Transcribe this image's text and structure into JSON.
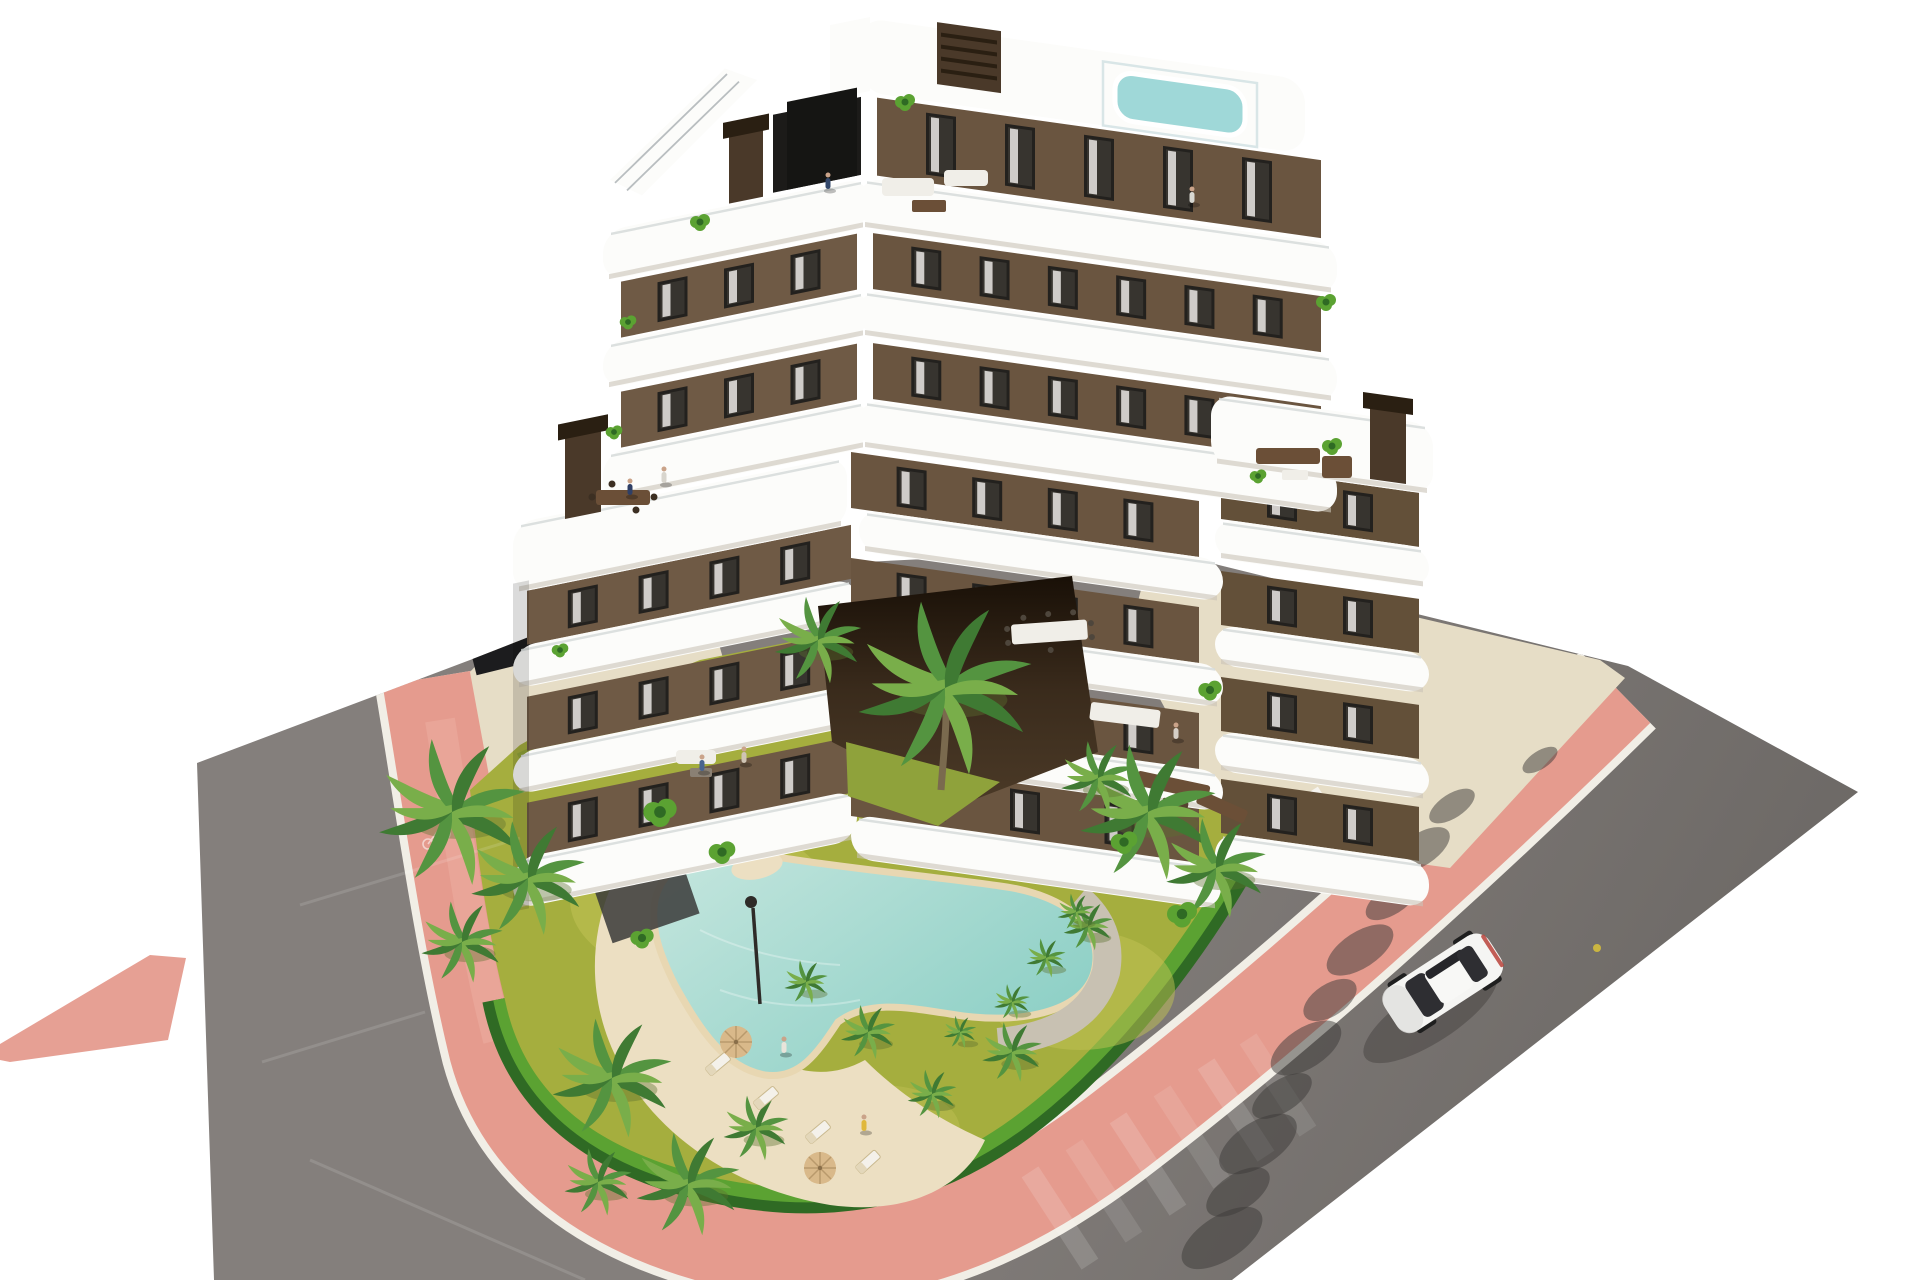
{
  "scene": {
    "kind": "aerial-architectural-render-of-apartment-building-with-pool-garden-and-road",
    "background": "white"
  },
  "palette": {
    "bg": "#ffffff",
    "road1": "#847f7c",
    "road2": "#6d6966",
    "pink": "#e59b8e",
    "pinkLight": "#eeb0a2",
    "curb": "#f1eee6",
    "beige": "#e6ddc6",
    "beigeTerr": "#dcd1ba",
    "grass": "#a5ae3e",
    "grassLight": "#c1c254",
    "grassDark": "#7e9a36",
    "hedgeDark": "#2f6a24",
    "hedgeLight": "#5ba232",
    "palmDark": "#3f7a33",
    "palmMid": "#549440",
    "palmLight": "#79ae4a",
    "trunk": "#7a6a4e",
    "sand": "#ecdfc2",
    "coping": "#e8d7b2",
    "water": "#8ccfc5",
    "waterLight": "#c5e6de",
    "gravel": "#c8c1b2",
    "slab": "#fcfcfa",
    "slabShadow": "#c9c3b8",
    "wallL": "#6f5a45",
    "wallC": "#6a5540",
    "wallR": "#635039",
    "winFrame": "#23211e",
    "winGlass": "#37342f",
    "curtain": "#eae8e4",
    "dark": "#1c1b19",
    "chimney": "#4a3929",
    "chimneyCap": "#2a1f12",
    "rail": "#d6dbd9",
    "furniture": "#6b4f37",
    "furnWhite": "#f0eee8",
    "carWhite": "#f5f5f3",
    "carGlass": "#2e2e32",
    "shadow": "#45423f",
    "blotch": "#3c3a38",
    "courtA": "#3a2b1c",
    "courtB": "#191007",
    "towel": "#e0b83c",
    "poolRoof": "#9fd8d8",
    "yellow": "#d9c23a"
  },
  "building": {
    "window": {
      "w": 30,
      "inset": 8
    },
    "left": {
      "walls": [
        {
          "x": -244,
          "y": 232,
          "w": 236,
          "h": 56,
          "n": 3
        },
        {
          "x": -244,
          "y": 342,
          "w": 236,
          "h": 56,
          "n": 3
        },
        {
          "x": -338,
          "y": 522,
          "w": 324,
          "h": 54,
          "n": 4
        },
        {
          "x": -338,
          "y": 628,
          "w": 324,
          "h": 54,
          "n": 4
        },
        {
          "x": -338,
          "y": 734,
          "w": 324,
          "h": 56,
          "n": 4
        }
      ],
      "slabs": [
        {
          "x": -262,
          "y": 178,
          "w": 266,
          "h": 50
        },
        {
          "x": -262,
          "y": 290,
          "w": 266,
          "h": 46
        },
        {
          "x": -262,
          "y": 400,
          "w": 266,
          "h": 48
        },
        {
          "x": -352,
          "y": 452,
          "w": 334,
          "h": 70
        },
        {
          "x": -352,
          "y": 576,
          "w": 344,
          "h": 42
        },
        {
          "x": -352,
          "y": 682,
          "w": 344,
          "h": 42
        },
        {
          "x": -352,
          "y": 788,
          "w": 344,
          "h": 50
        }
      ]
    },
    "right": {
      "walls": [
        {
          "x": 12,
          "y": 96,
          "w": 444,
          "h": 78,
          "n": 5
        },
        {
          "x": 8,
          "y": 232,
          "w": 448,
          "h": 56,
          "n": 6
        },
        {
          "x": 8,
          "y": 342,
          "w": 448,
          "h": 56,
          "n": 6
        },
        {
          "x": -14,
          "y": 454,
          "w": 348,
          "h": 56,
          "n": 4
        },
        {
          "x": -14,
          "y": 560,
          "w": 348,
          "h": 56,
          "n": 4
        },
        {
          "x": -14,
          "y": 666,
          "w": 348,
          "h": 56,
          "n": 4
        },
        {
          "x": -14,
          "y": 760,
          "w": 348,
          "h": 58,
          "n": 3
        },
        {
          "x": 356,
          "y": 415,
          "w": 198,
          "h": 54,
          "n": 2
        },
        {
          "x": 356,
          "y": 521,
          "w": 198,
          "h": 54,
          "n": 2
        },
        {
          "x": 356,
          "y": 627,
          "w": 198,
          "h": 54,
          "n": 2
        },
        {
          "x": 356,
          "y": 729,
          "w": 198,
          "h": 54,
          "n": 2
        }
      ],
      "slabs": [
        {
          "x": -6,
          "y": 178,
          "w": 478,
          "h": 50
        },
        {
          "x": -6,
          "y": 290,
          "w": 478,
          "h": 46
        },
        {
          "x": -6,
          "y": 400,
          "w": 478,
          "h": 48
        },
        {
          "x": 346,
          "y": 345,
          "w": 222,
          "h": 70
        },
        {
          "x": -6,
          "y": 510,
          "w": 364,
          "h": 42
        },
        {
          "x": -6,
          "y": 616,
          "w": 364,
          "h": 42
        },
        {
          "x": -6,
          "y": 722,
          "w": 364,
          "h": 40
        },
        {
          "x": 350,
          "y": 469,
          "w": 214,
          "h": 40
        },
        {
          "x": 350,
          "y": 575,
          "w": 214,
          "h": 40
        },
        {
          "x": 350,
          "y": 681,
          "w": 214,
          "h": 40
        },
        {
          "x": 350,
          "y": 783,
          "w": 214,
          "h": 46
        },
        {
          "x": -14,
          "y": 816,
          "w": 370,
          "h": 44
        }
      ]
    }
  },
  "palms": [
    {
      "x": 452,
      "y": 812,
      "s": 1.35
    },
    {
      "x": 528,
      "y": 878,
      "s": 1.05
    },
    {
      "x": 462,
      "y": 942,
      "s": 0.75
    },
    {
      "x": 612,
      "y": 1078,
      "s": 1.1
    },
    {
      "x": 688,
      "y": 1184,
      "s": 0.95
    },
    {
      "x": 598,
      "y": 1182,
      "s": 0.62
    },
    {
      "x": 756,
      "y": 1128,
      "s": 0.6
    },
    {
      "x": 945,
      "y": 688,
      "s": 1.6
    },
    {
      "x": 818,
      "y": 640,
      "s": 0.8
    },
    {
      "x": 1148,
      "y": 812,
      "s": 1.25
    },
    {
      "x": 1216,
      "y": 868,
      "s": 0.92
    },
    {
      "x": 1098,
      "y": 778,
      "s": 0.68
    },
    {
      "x": 868,
      "y": 1032,
      "s": 0.5
    },
    {
      "x": 1012,
      "y": 1052,
      "s": 0.55
    },
    {
      "x": 932,
      "y": 1094,
      "s": 0.45
    },
    {
      "x": 1088,
      "y": 926,
      "s": 0.45
    },
    {
      "x": 806,
      "y": 982,
      "s": 0.4
    },
    {
      "x": 1076,
      "y": 912,
      "s": 0.34
    },
    {
      "x": 1046,
      "y": 958,
      "s": 0.36
    },
    {
      "x": 1012,
      "y": 1002,
      "s": 0.33
    },
    {
      "x": 960,
      "y": 1032,
      "s": 0.3
    }
  ],
  "bushes": [
    {
      "x": 660,
      "y": 812,
      "s": 10
    },
    {
      "x": 722,
      "y": 852,
      "s": 8
    },
    {
      "x": 1182,
      "y": 914,
      "s": 9
    },
    {
      "x": 642,
      "y": 938,
      "s": 7
    },
    {
      "x": 1124,
      "y": 842,
      "s": 8
    },
    {
      "x": 700,
      "y": 222,
      "s": 6
    },
    {
      "x": 628,
      "y": 322,
      "s": 5
    },
    {
      "x": 1326,
      "y": 302,
      "s": 6
    },
    {
      "x": 614,
      "y": 432,
      "s": 5
    },
    {
      "x": 1332,
      "y": 446,
      "s": 6
    },
    {
      "x": 905,
      "y": 102,
      "s": 6
    },
    {
      "x": 560,
      "y": 650,
      "s": 5
    },
    {
      "x": 1258,
      "y": 476,
      "s": 5
    },
    {
      "x": 1210,
      "y": 690,
      "s": 7
    }
  ],
  "loungers": [
    {
      "x": 718,
      "y": 1064,
      "r": -40
    },
    {
      "x": 766,
      "y": 1098,
      "r": -40
    },
    {
      "x": 818,
      "y": 1132,
      "r": -40
    },
    {
      "x": 868,
      "y": 1162,
      "r": -42
    }
  ],
  "umbrellas": [
    {
      "x": 736,
      "y": 1042
    },
    {
      "x": 820,
      "y": 1168
    }
  ],
  "people": [
    {
      "x": 828,
      "y": 182,
      "c": "#33486b"
    },
    {
      "x": 1192,
      "y": 196,
      "c": "#d8d8d2"
    },
    {
      "x": 630,
      "y": 488,
      "c": "#2f3f66"
    },
    {
      "x": 664,
      "y": 476,
      "c": "#d8d5cd"
    },
    {
      "x": 702,
      "y": 764,
      "c": "#49648f"
    },
    {
      "x": 744,
      "y": 756,
      "c": "#cfc4b4"
    },
    {
      "x": 1176,
      "y": 732,
      "c": "#d6cfc6"
    },
    {
      "x": 864,
      "y": 1124,
      "c": "#e0b83c"
    },
    {
      "x": 784,
      "y": 1046,
      "c": "#e8e4da"
    }
  ],
  "blotches": [
    {
      "x": 1540,
      "y": 760,
      "rx": 20,
      "ry": 9
    },
    {
      "x": 1452,
      "y": 806,
      "rx": 26,
      "ry": 12
    },
    {
      "x": 1420,
      "y": 850,
      "rx": 34,
      "ry": 16
    },
    {
      "x": 1392,
      "y": 900,
      "rx": 30,
      "ry": 14
    },
    {
      "x": 1360,
      "y": 950,
      "rx": 38,
      "ry": 18
    },
    {
      "x": 1330,
      "y": 1000,
      "rx": 30,
      "ry": 16
    },
    {
      "x": 1306,
      "y": 1048,
      "rx": 40,
      "ry": 20
    },
    {
      "x": 1282,
      "y": 1096,
      "rx": 34,
      "ry": 16
    },
    {
      "x": 1258,
      "y": 1144,
      "rx": 44,
      "ry": 22
    },
    {
      "x": 1238,
      "y": 1192,
      "rx": 36,
      "ry": 18
    },
    {
      "x": 1222,
      "y": 1238,
      "rx": 46,
      "ry": 22
    }
  ],
  "crosswalk": [
    {
      "x": 1060,
      "y": 1218
    },
    {
      "x": 1104,
      "y": 1191
    },
    {
      "x": 1148,
      "y": 1164
    },
    {
      "x": 1192,
      "y": 1137
    },
    {
      "x": 1236,
      "y": 1110
    },
    {
      "x": 1278,
      "y": 1085
    }
  ],
  "scratches": [
    {
      "x1": 300,
      "y1": 905,
      "x2": 520,
      "y2": 838
    },
    {
      "x1": 262,
      "y1": 1062,
      "x2": 425,
      "y2": 1012
    },
    {
      "x1": 310,
      "y1": 1160,
      "x2": 585,
      "y2": 1280
    }
  ],
  "car": {
    "x": 1443,
    "y": 983,
    "rot": -33
  }
}
